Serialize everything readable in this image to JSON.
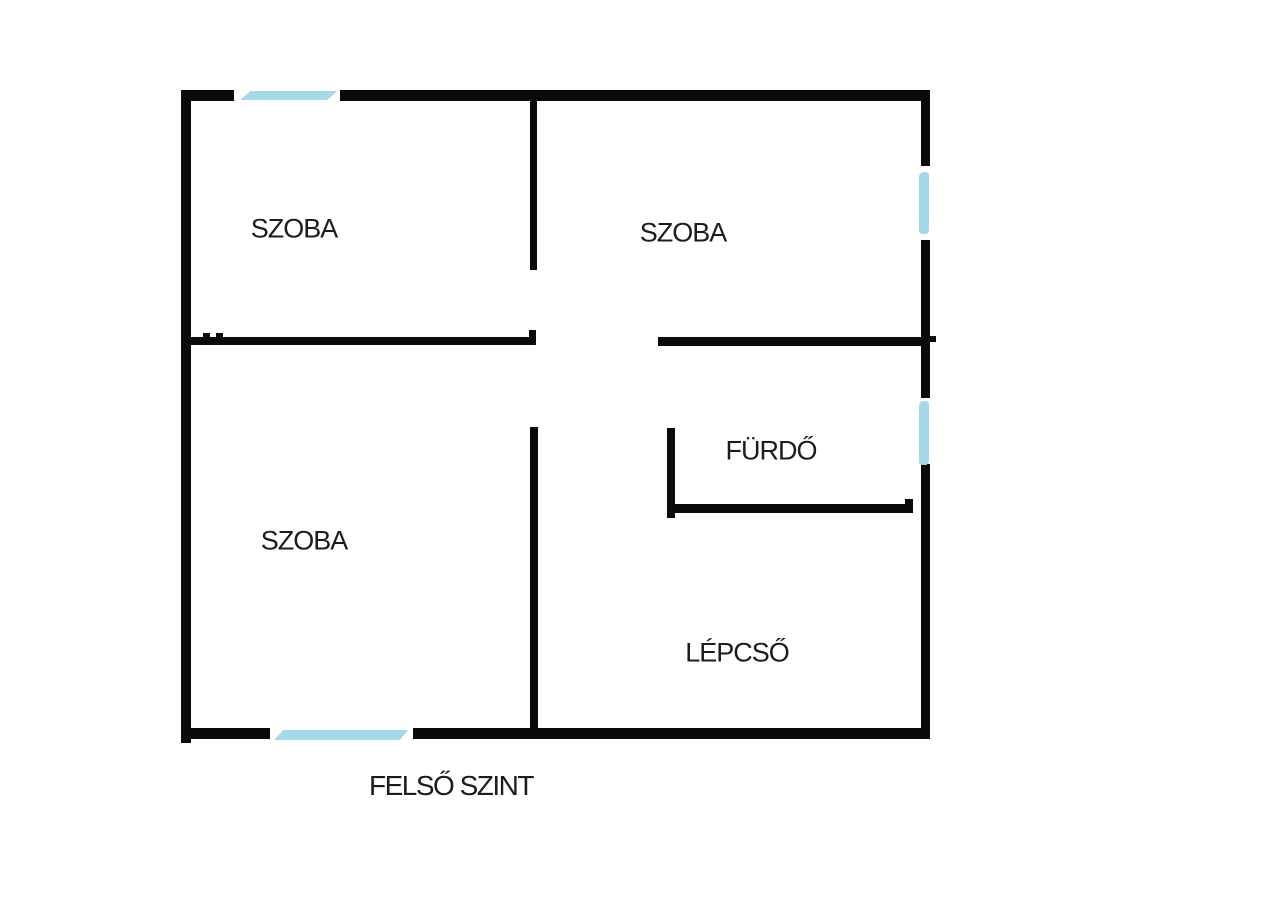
{
  "title": "FELSŐ SZINT",
  "colors": {
    "wall": "#0a0a0a",
    "window": "#a6d8e8",
    "background": "#ffffff",
    "text": "#1c1c1c"
  },
  "rooms": [
    {
      "name": "room-top-left",
      "label": "SZOBA"
    },
    {
      "name": "room-top-right",
      "label": "SZOBA"
    },
    {
      "name": "room-bottom-left",
      "label": "SZOBA"
    },
    {
      "name": "bathroom",
      "label": "FÜRDŐ"
    },
    {
      "name": "staircase",
      "label": "LÉPCSŐ"
    }
  ]
}
